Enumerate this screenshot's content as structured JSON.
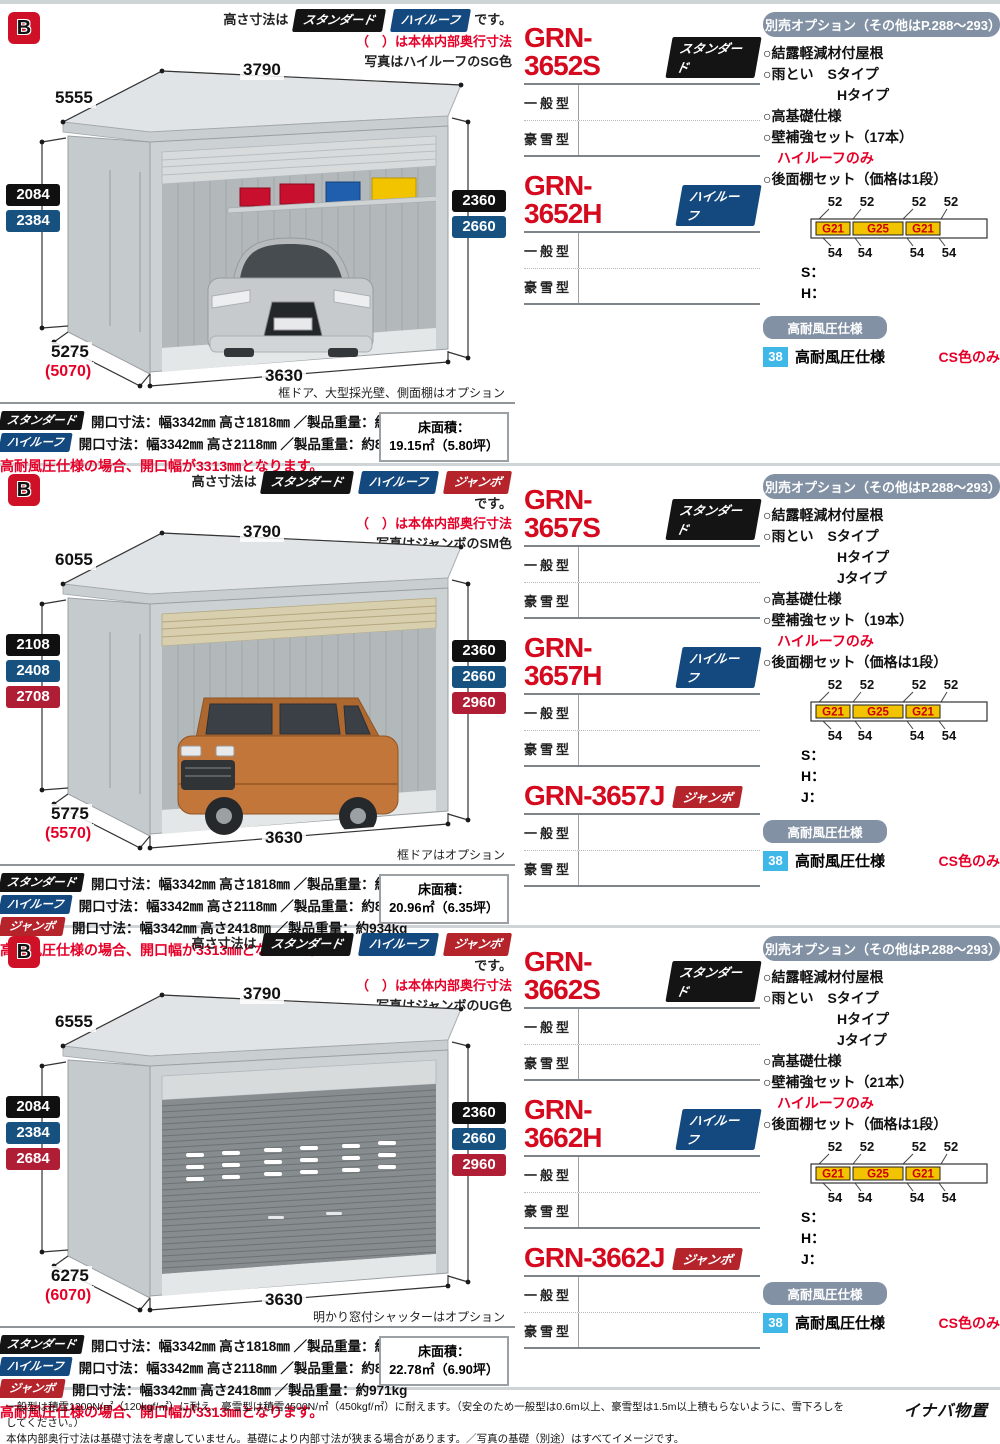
{
  "shared": {
    "b_label": "B",
    "options_header": "別売オプション（その他はP.288〜293）",
    "row_general": "一般型",
    "row_snow": "豪雪型",
    "shelf": {
      "top_nums": [
        "52",
        "52",
        "52",
        "52"
      ],
      "boxes": [
        "G21",
        "G25",
        "G21"
      ],
      "bottom_nums": [
        "54",
        "54",
        "54",
        "54"
      ]
    },
    "wind": {
      "pill": "高耐風圧仕様",
      "badge": "38",
      "label": "高耐風圧仕様",
      "note": "CS色のみ"
    }
  },
  "sections": [
    {
      "height_note": {
        "prefix": "高さ寸法は",
        "types": [
          "スタンダード",
          "ハイルーフ"
        ],
        "suffix": "です。"
      },
      "inner_note": "（　）は本体内部奥行寸法",
      "photo_note": "写真はハイルーフのSG色",
      "dims": {
        "top_width": "3790",
        "top_depth": "5555",
        "left_heights": [
          "2084",
          "2384"
        ],
        "right_heights": [
          "2360",
          "2660"
        ],
        "bottom_depth": "5275",
        "bottom_depth_inner": "(5070)",
        "bottom_width": "3630"
      },
      "caption": "框ドア、大型採光壁、側面棚はオプション",
      "models": [
        {
          "name": "GRN-3652S",
          "badge": "スタンダード"
        },
        {
          "name": "GRN-3652H",
          "badge": "ハイルーフ"
        }
      ],
      "options_items": [
        "○結露軽減材付屋根",
        "○雨とい　Sタイプ",
        "Hタイプ",
        "○高基礎仕様",
        "○壁補強セット（17本）",
        "ハイルーフのみ",
        "○後面棚セット（価格は1段）"
      ],
      "size_lines": [
        "S：",
        "H："
      ],
      "specs": [
        {
          "badge": "スタンダード",
          "text": "開口寸法：幅3342㎜ 高さ1818㎜ ／製品重量：約734kg"
        },
        {
          "badge": "ハイルーフ",
          "text": "開口寸法：幅3342㎜ 高さ2118㎜ ／製品重量：約818kg"
        }
      ],
      "floor": {
        "label": "床面積：",
        "value": "19.15㎡（5.80坪）"
      },
      "spec_note": "高耐風圧仕様の場合、開口幅が3313㎜となります。"
    },
    {
      "height_note": {
        "prefix": "高さ寸法は",
        "types": [
          "スタンダード",
          "ハイルーフ",
          "ジャンボ"
        ],
        "suffix": "です。"
      },
      "inner_note": "（　）は本体内部奥行寸法",
      "photo_note": "写真はジャンボのSM色",
      "dims": {
        "top_width": "3790",
        "top_depth": "6055",
        "left_heights": [
          "2108",
          "2408",
          "2708"
        ],
        "right_heights": [
          "2360",
          "2660",
          "2960"
        ],
        "bottom_depth": "5775",
        "bottom_depth_inner": "(5570)",
        "bottom_width": "3630"
      },
      "caption": "框ドアはオプション",
      "models": [
        {
          "name": "GRN-3657S",
          "badge": "スタンダード"
        },
        {
          "name": "GRN-3657H",
          "badge": "ハイルーフ"
        },
        {
          "name": "GRN-3657J",
          "badge": "ジャンボ"
        }
      ],
      "options_items": [
        "○結露軽減材付屋根",
        "○雨とい　Sタイプ",
        "Hタイプ",
        "Jタイプ",
        "○高基礎仕様",
        "○壁補強セット（19本）",
        "ハイルーフのみ",
        "○後面棚セット（価格は1段）"
      ],
      "size_lines": [
        "S：",
        "H：",
        "J："
      ],
      "specs": [
        {
          "badge": "スタンダード",
          "text": "開口寸法：幅3342㎜ 高さ1818㎜ ／製品重量：約770kg"
        },
        {
          "badge": "ハイルーフ",
          "text": "開口寸法：幅3342㎜ 高さ2118㎜ ／製品重量：約858kg"
        },
        {
          "badge": "ジャンボ",
          "text": "開口寸法：幅3342㎜ 高さ2418㎜ ／製品重量：約934kg"
        }
      ],
      "floor": {
        "label": "床面積：",
        "value": "20.96㎡（6.35坪）"
      },
      "spec_note": "高耐風圧仕様の場合、開口幅が3313㎜となります。"
    },
    {
      "height_note": {
        "prefix": "高さ寸法は",
        "types": [
          "スタンダード",
          "ハイルーフ",
          "ジャンボ"
        ],
        "suffix": "です。"
      },
      "inner_note": "（　）は本体内部奥行寸法",
      "photo_note": "写真はジャンボのUG色",
      "dims": {
        "top_width": "3790",
        "top_depth": "6555",
        "left_heights": [
          "2084",
          "2384",
          "2684"
        ],
        "right_heights": [
          "2360",
          "2660",
          "2960"
        ],
        "bottom_depth": "6275",
        "bottom_depth_inner": "(6070)",
        "bottom_width": "3630"
      },
      "caption": "明かり窓付シャッターはオプション",
      "models": [
        {
          "name": "GRN-3662S",
          "badge": "スタンダード"
        },
        {
          "name": "GRN-3662H",
          "badge": "ハイルーフ"
        },
        {
          "name": "GRN-3662J",
          "badge": "ジャンボ"
        }
      ],
      "options_items": [
        "○結露軽減材付屋根",
        "○雨とい　Sタイプ",
        "Hタイプ",
        "Jタイプ",
        "○高基礎仕様",
        "○壁補強セット（21本）",
        "ハイルーフのみ",
        "○後面棚セット（価格は1段）"
      ],
      "size_lines": [
        "S：",
        "H：",
        "J："
      ],
      "specs": [
        {
          "badge": "スタンダード",
          "text": "開口寸法：幅3342㎜ 高さ1818㎜ ／製品重量：約797kg"
        },
        {
          "badge": "ハイルーフ",
          "text": "開口寸法：幅3342㎜ 高さ2118㎜ ／製品重量：約890kg"
        },
        {
          "badge": "ジャンボ",
          "text": "開口寸法：幅3342㎜ 高さ2418㎜ ／製品重量：約971kg"
        }
      ],
      "floor": {
        "label": "床面積：",
        "value": "22.78㎡（6.90坪）"
      },
      "spec_note": "高耐風圧仕様の場合、開口幅が3313㎜となります。"
    }
  ],
  "footer": {
    "line1": "一般型は積雪1200N/㎡（120kgf/㎡）に耐え、豪雪型は積雪4500N/㎡（450kgf/㎡）に耐えます。（安全のため一般型は0.6m以上、豪雪型は1.5m以上積もらないように、雪下ろしをしてください。）",
    "line2": "本体内部奥行寸法は基礎寸法を考慮していません。基礎により内部寸法が狭まる場合があります。／写真の基礎（別途）はすべてイメージです。",
    "brand": "イナバ物置"
  }
}
